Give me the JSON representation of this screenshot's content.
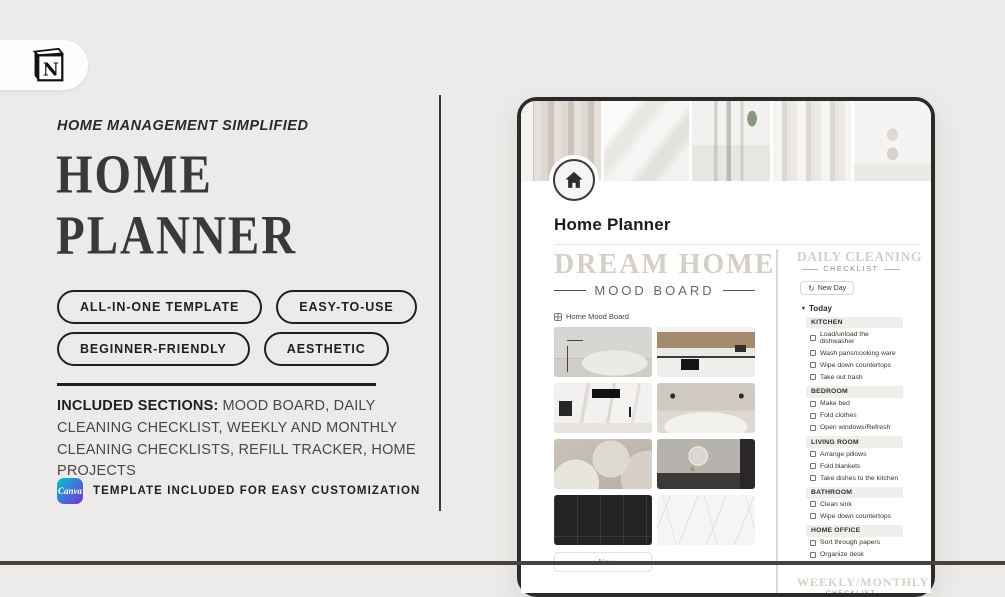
{
  "page": {
    "background_color": "#edebe9",
    "bottom_edge_color": "#454240"
  },
  "icons": {
    "app_logo": "notion-icon",
    "page_icon": "home-icon",
    "gallery": "gallery-grid-icon",
    "refresh": "refresh-icon",
    "group_toggle": "triangle-down-icon",
    "checkbox": "checkbox-empty-icon"
  },
  "colors": {
    "stencil_heading": "#d6cfc7",
    "dark_text": "#21201e",
    "canva_gradient_start": "#00c4cc",
    "canva_gradient_end": "#7a2ce0"
  },
  "left_panel": {
    "eyebrow": "HOME MANAGEMENT SIMPLIFIED",
    "title": {
      "line1": "HOME",
      "line2": "PLANNER"
    },
    "badges": [
      "ALL-IN-ONE TEMPLATE",
      "EASY-TO-USE",
      "BEGINNER-FRIENDLY",
      "AESTHETIC"
    ],
    "included": {
      "label": "INCLUDED SECTIONS:",
      "text": "MOOD BOARD, DAILY CLEANING CHECKLIST, WEEKLY AND MONTHLY CLEANING CHECKLISTS, REFILL TRACKER, HOME PROJECTS"
    },
    "canva": {
      "logo_text": "Canva",
      "note": "TEMPLATE INCLUDED FOR EASY CUSTOMIZATION"
    }
  },
  "mockup": {
    "page_title": "Home Planner",
    "cover_photos": [
      "curtain",
      "white-bedding",
      "glass-vases-tulips",
      "white-column",
      "hourglass"
    ],
    "mood_board": {
      "heading": "DREAM HOME",
      "subheading": "MOOD BOARD",
      "gallery_label": "Home Mood Board",
      "images": [
        "living-room-sofa",
        "kitchen-wood-cabinets",
        "kitchen-marble-counter",
        "white-bedroom",
        "abstract-sculpture",
        "bathroom-round-mirror",
        "black-wall-paneling",
        "white-marble-texture"
      ],
      "new_button_label": "+ New"
    },
    "daily_checklist": {
      "heading": "DAILY CLEANING",
      "subheading": "CHECKLIST",
      "new_day_button": "New Day",
      "group_toggle": "Today",
      "sections": [
        {
          "name": "KITCHEN",
          "items": [
            "Load/unload the dishwasher",
            "Wash pans/cooking ware",
            "Wipe down countertops",
            "Take out trash"
          ]
        },
        {
          "name": "BEDROOM",
          "items": [
            "Make bed",
            "Fold clothes",
            "Open windows/Refresh"
          ]
        },
        {
          "name": "LIVING ROOM",
          "items": [
            "Arrange pillows",
            "Fold blankets",
            "Take dishes to the kitchen"
          ]
        },
        {
          "name": "BATHROOM",
          "items": [
            "Clean sink",
            "Wipe down countertops"
          ]
        },
        {
          "name": "HOME OFFICE",
          "items": [
            "Sort through papers",
            "Organize desk"
          ]
        }
      ]
    },
    "weekly_checklist": {
      "heading": "WEEKLY/MONTHLY",
      "subheading": "CHECKLIST"
    }
  }
}
